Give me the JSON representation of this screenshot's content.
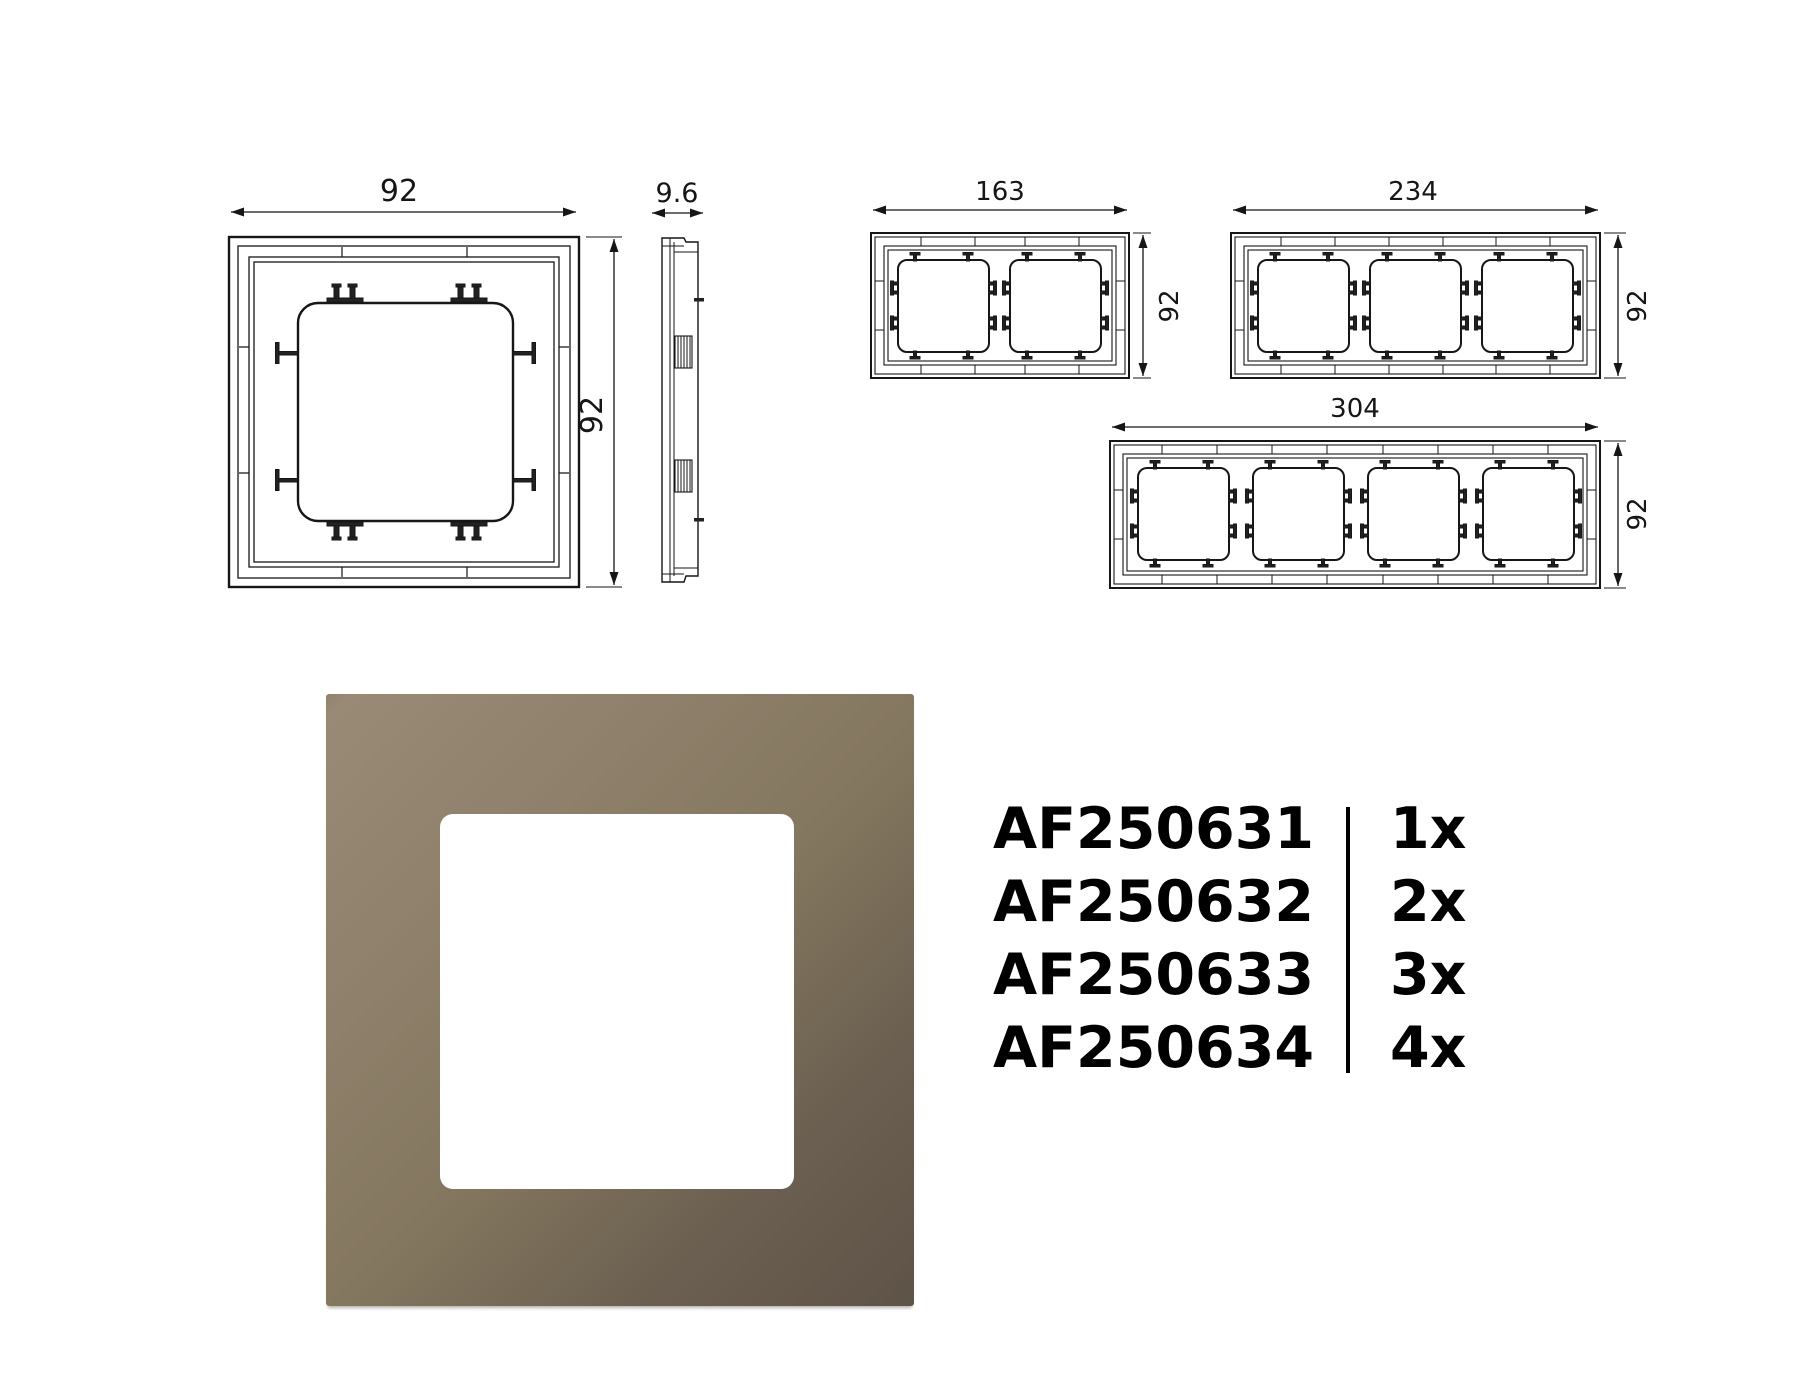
{
  "drawings": {
    "front_1gang": {
      "width_label": "92",
      "height_label": "92"
    },
    "side_view": {
      "depth_label": "9.6"
    },
    "front_2gang": {
      "width_label": "163",
      "height_label": "92"
    },
    "front_3gang": {
      "width_label": "234",
      "height_label": "92"
    },
    "front_4gang": {
      "width_label": "304",
      "height_label": "92"
    }
  },
  "product_photo": {
    "frame_color_start": "#998a76",
    "frame_color_end": "#5e5347",
    "cutout_color": "#ffffff"
  },
  "parts": {
    "items": [
      {
        "code": "AF250631",
        "qty": "1x"
      },
      {
        "code": "AF250632",
        "qty": "2x"
      },
      {
        "code": "AF250633",
        "qty": "3x"
      },
      {
        "code": "AF250634",
        "qty": "4x"
      }
    ]
  }
}
